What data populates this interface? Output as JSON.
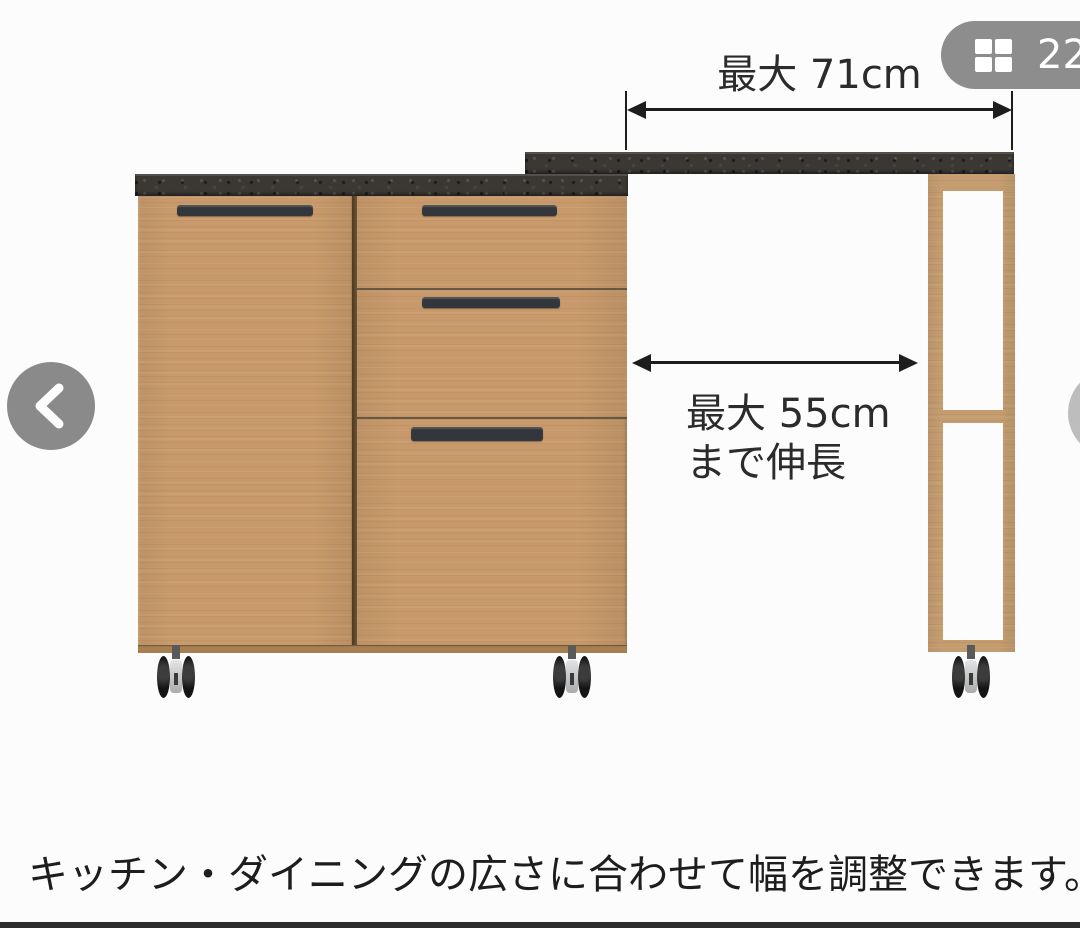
{
  "photo_badge": {
    "count": "22",
    "icon": "grid-gallery-icon",
    "bg_color": "#8d8d8d"
  },
  "carousel_nav": {
    "prev_icon": "chevron-left-icon",
    "next_icon": "chevron-right-icon",
    "button_color": "#8a8a8a"
  },
  "annotations": {
    "top_width_label": "最大 71cm",
    "extension_label_line1": "最大 55cm",
    "extension_label_line2": "まで伸長",
    "caption": "キッチン・ダイニングの広さに合わせて幅を調整できます。"
  },
  "furniture_colors": {
    "wood": "#c89a6b",
    "countertop": "#3b3834",
    "handle": "#33363a",
    "arrow": "#1d1d1d",
    "bottom_bar": "#2d2d2d"
  }
}
